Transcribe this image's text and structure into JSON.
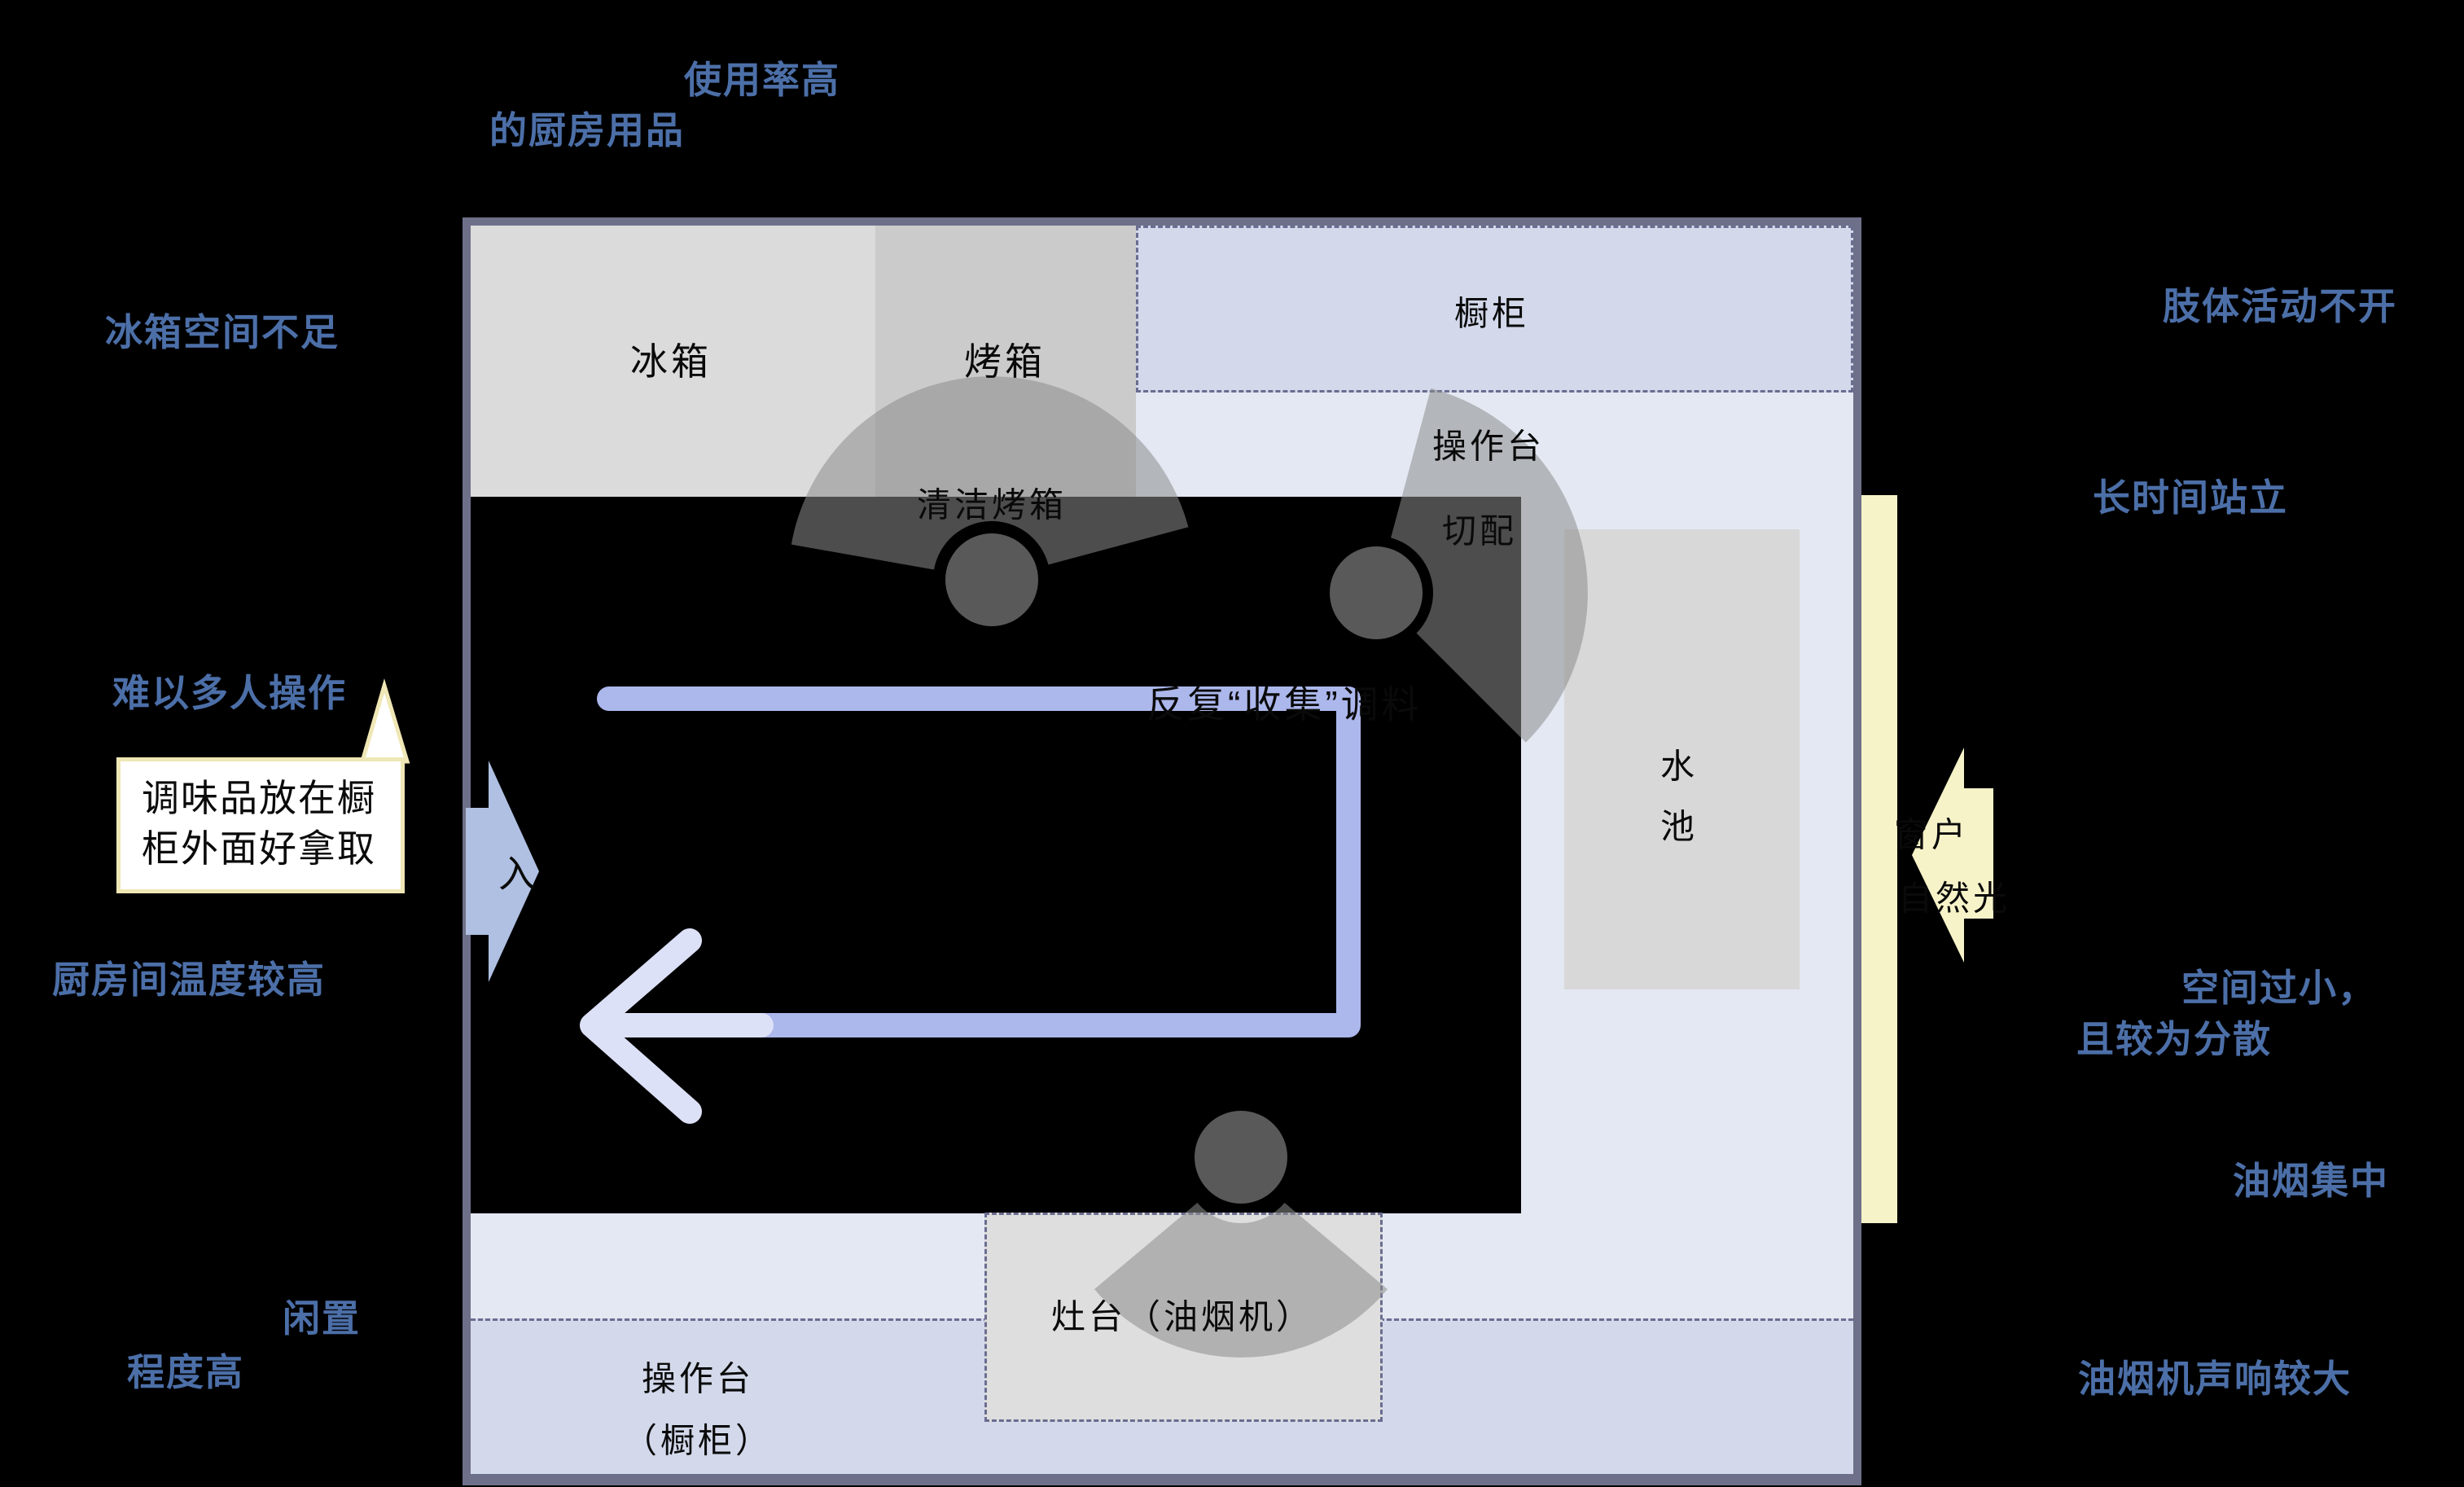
{
  "colors": {
    "background": "#000000",
    "annotation_blue": "#4C6FA8",
    "interior": "#E3E8F2",
    "bottom_counter": "#D3D9EB",
    "fridge": "#DBDBDB",
    "oven": "#CBCBCB",
    "cabinet": "#D3D9EB",
    "sink": "#D8D8D8",
    "stove": "#DEDEDE",
    "wall": "#6E7089",
    "dashed_border": "#6A6D90",
    "path_blue": "#ACB7EC",
    "path_light": "#DDE1F7",
    "entrance_arrow": "#AFC0E2",
    "window_yellow": "#F6F3C9",
    "person_head": "#595959",
    "person_fan": "rgba(140,140,140,0.55)",
    "bubble_border": "#EFE7B5",
    "bubble_fill": "#FFFFFF"
  },
  "blocks": {
    "fridge": "冰箱",
    "oven": "烤箱",
    "cabinet": "橱柜",
    "counter_top": "操作台",
    "cut": "切配",
    "clean_oven": "清洁烤箱",
    "sink_l1": "水",
    "sink_l2": "池",
    "stove": "灶台（油烟机）",
    "bottom_counter_l1": "操作台",
    "bottom_counter_l2": "（橱柜）",
    "collect": "反复“收集”调料",
    "enter": "入",
    "window": "窗户",
    "natural_light": "自然光"
  },
  "annotations": {
    "usage_l1": "使用率高",
    "usage_l2": "的厨房用品",
    "fridge_space": "冰箱空间不足",
    "multi_user": "难以多人操作",
    "temperature": "厨房间温度较高",
    "idle_l1": "闲置",
    "idle_l2": "程度高",
    "body": "肢体活动不开",
    "standing": "长时间站立",
    "small_l1": "空间过小，",
    "small_l2": "且较为分散",
    "fume": "油烟集中",
    "hood_noise": "油烟机声响较大"
  },
  "bubble": {
    "l1": "调味品放在橱",
    "l2": "柜外面好拿取"
  }
}
